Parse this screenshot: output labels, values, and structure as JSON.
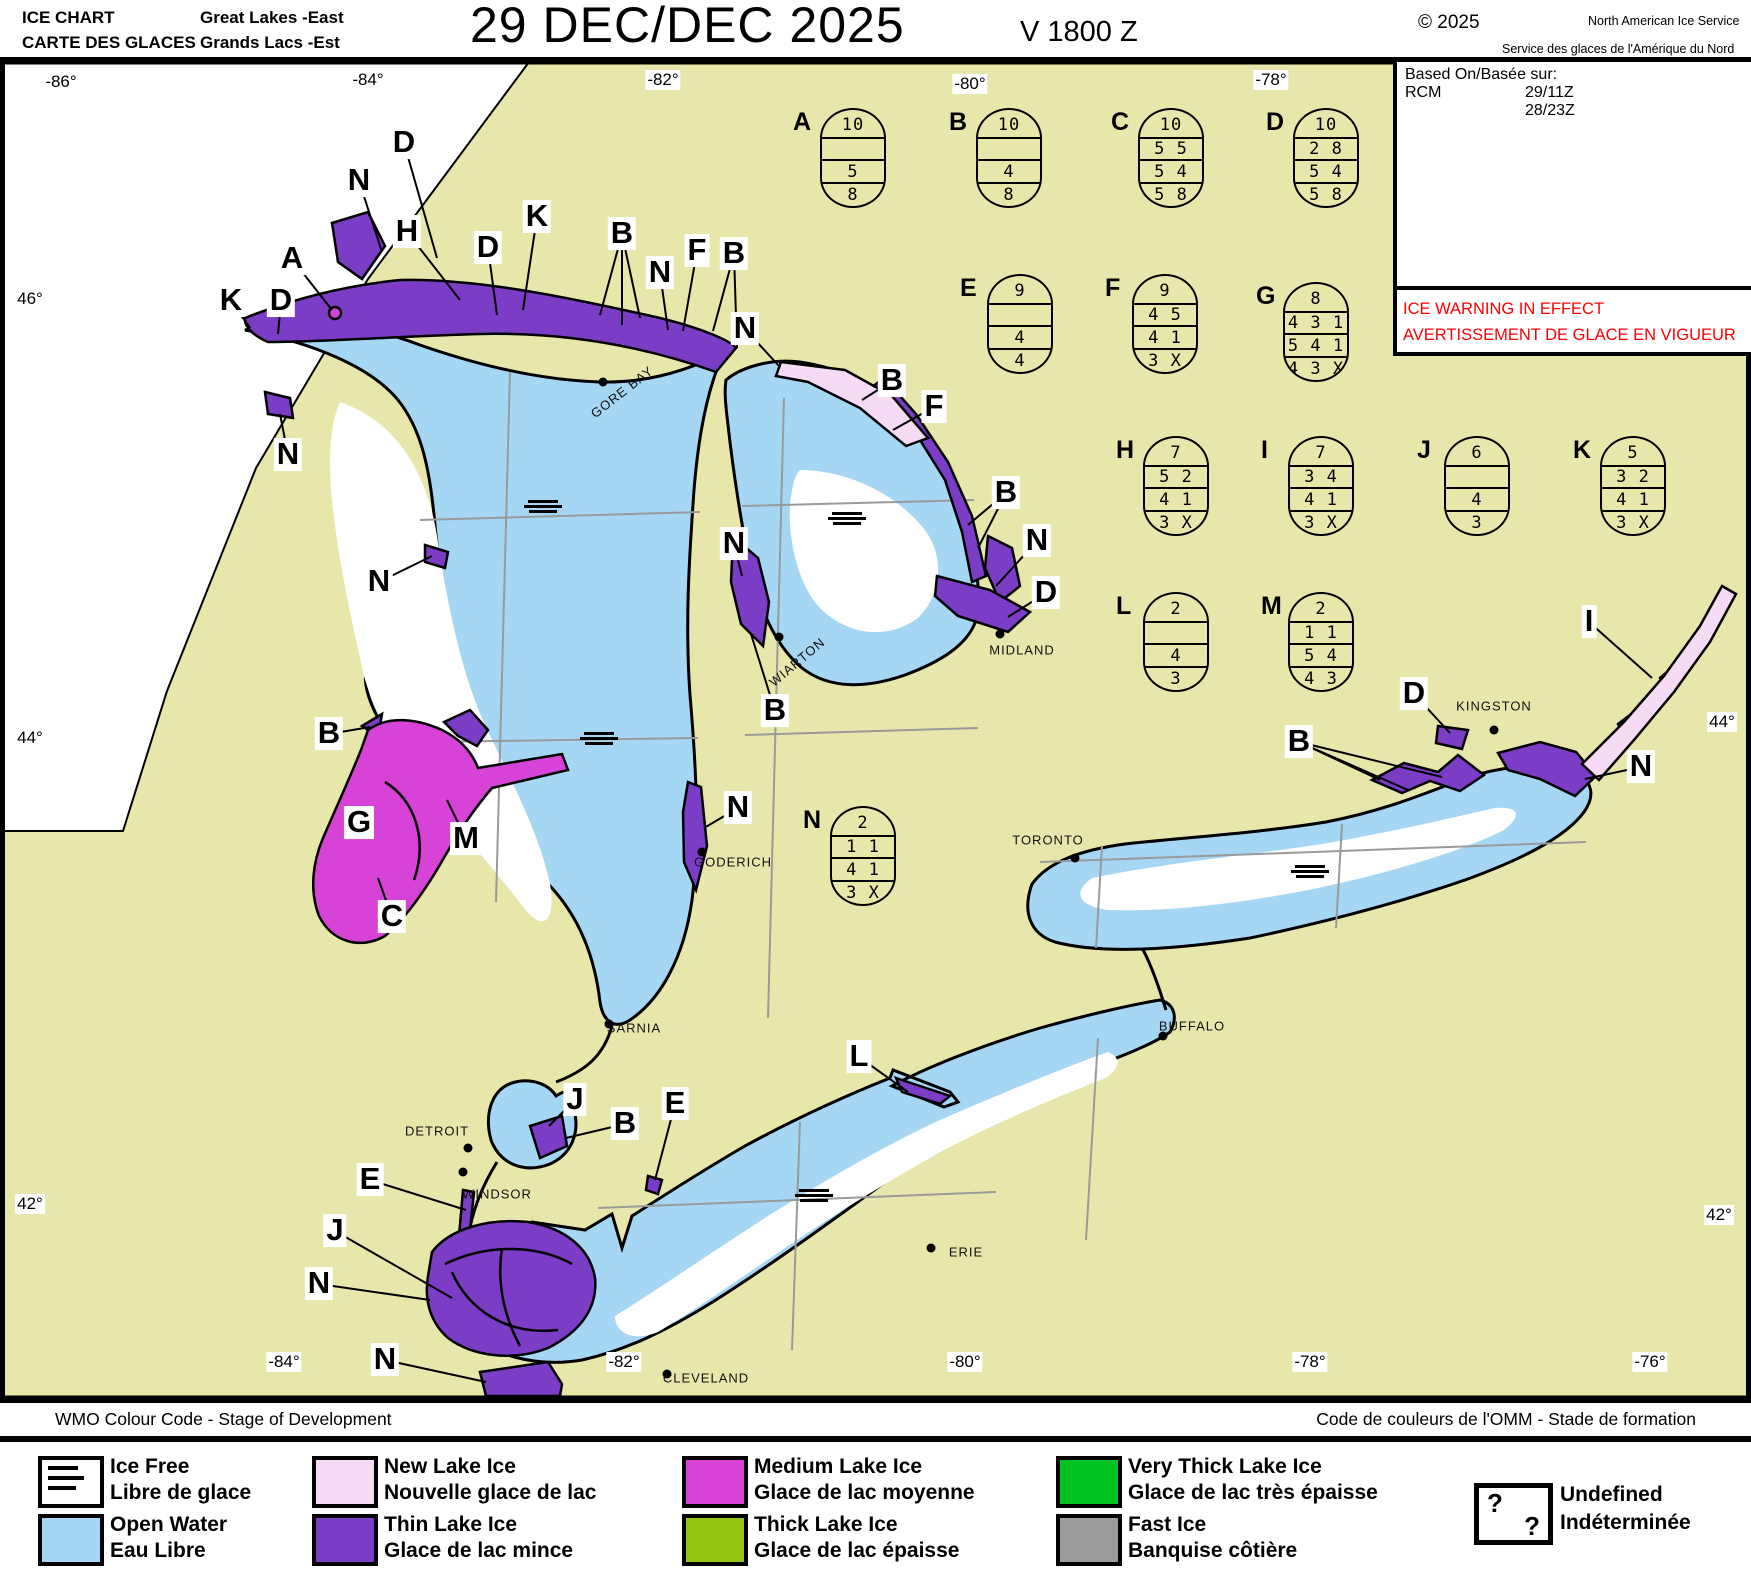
{
  "header": {
    "l1": "ICE CHART",
    "l2": "CARTE DES GLACES",
    "region_en": "Great Lakes -East",
    "region_fr": "Grands Lacs -Est",
    "title": "29 DEC/DEC 2025",
    "valid": "V 1800 Z",
    "copyright": "© 2025",
    "agency_en": "North American Ice Service",
    "agency_fr": "Service des glaces de l'Amérique du Nord"
  },
  "based_on": {
    "label": "Based On/Basée sur:",
    "source": "RCM",
    "t1": "29/11Z",
    "t2": "28/23Z"
  },
  "warning": {
    "line1": "ICE WARNING IN EFFECT",
    "line2": "AVERTISSEMENT DE GLACE EN VIGUEUR"
  },
  "colors": {
    "land": "#e8e7ab",
    "open_water": "#a5d6f4",
    "ice_free": "#ffffff",
    "new_lake_ice": "#f7dbf5",
    "thin_lake_ice": "#7b3cc6",
    "medium_lake_ice": "#d643d6",
    "thick_lake_ice": "#94c414",
    "very_thick_lake_ice": "#00c321",
    "fast_ice": "#9b9b9b",
    "warning_red": "#ff0000",
    "grid": "#9a9a9a"
  },
  "coords": {
    "top": [
      {
        "t": "-86°",
        "x": 61,
        "y": 82
      },
      {
        "t": "-84°",
        "x": 368,
        "y": 80
      },
      {
        "t": "-82°",
        "x": 663,
        "y": 80
      },
      {
        "t": "-80°",
        "x": 970,
        "y": 84
      },
      {
        "t": "-78°",
        "x": 1271,
        "y": 80
      }
    ],
    "bottom": [
      {
        "t": "-84°",
        "x": 284,
        "y": 1362
      },
      {
        "t": "-82°",
        "x": 624,
        "y": 1362
      },
      {
        "t": "-80°",
        "x": 965,
        "y": 1362
      },
      {
        "t": "-78°",
        "x": 1310,
        "y": 1362
      },
      {
        "t": "-76°",
        "x": 1650,
        "y": 1362
      }
    ],
    "left": [
      {
        "t": "46°",
        "x": 30,
        "y": 299
      },
      {
        "t": "44°",
        "x": 30,
        "y": 738
      },
      {
        "t": "42°",
        "x": 30,
        "y": 1204
      }
    ],
    "right": [
      {
        "t": "44°",
        "x": 1722,
        "y": 722
      },
      {
        "t": "42°",
        "x": 1719,
        "y": 1215
      }
    ]
  },
  "eggs": [
    {
      "id": "A",
      "x": 820,
      "y": 108,
      "rows": [
        "10",
        "",
        "5",
        "8"
      ]
    },
    {
      "id": "B",
      "x": 976,
      "y": 108,
      "rows": [
        "10",
        "",
        "4",
        "8"
      ]
    },
    {
      "id": "C",
      "x": 1138,
      "y": 108,
      "rows": [
        "10",
        "5 5",
        "5 4",
        "5 8"
      ]
    },
    {
      "id": "D",
      "x": 1293,
      "y": 108,
      "rows": [
        "10",
        "2 8",
        "5 4",
        "5 8"
      ]
    },
    {
      "id": "E",
      "x": 987,
      "y": 274,
      "rows": [
        "9",
        "",
        "4",
        "4"
      ]
    },
    {
      "id": "F",
      "x": 1132,
      "y": 274,
      "rows": [
        "9",
        "4 5",
        "4 1",
        "3 X"
      ]
    },
    {
      "id": "G",
      "x": 1283,
      "y": 282,
      "rows": [
        "8",
        "4 3 1",
        "5 4 1",
        "4 3 X"
      ]
    },
    {
      "id": "H",
      "x": 1143,
      "y": 436,
      "rows": [
        "7",
        "5 2",
        "4 1",
        "3 X"
      ]
    },
    {
      "id": "I",
      "x": 1288,
      "y": 436,
      "rows": [
        "7",
        "3 4",
        "4 1",
        "3 X"
      ]
    },
    {
      "id": "J",
      "x": 1444,
      "y": 436,
      "rows": [
        "6",
        "",
        "4",
        "3"
      ]
    },
    {
      "id": "K",
      "x": 1600,
      "y": 436,
      "rows": [
        "5",
        "3 2",
        "4 1",
        "3 X"
      ]
    },
    {
      "id": "L",
      "x": 1143,
      "y": 592,
      "rows": [
        "2",
        "",
        "4",
        "3"
      ]
    },
    {
      "id": "M",
      "x": 1288,
      "y": 592,
      "rows": [
        "2",
        "1 1",
        "5 4",
        "4 3"
      ]
    },
    {
      "id": "N",
      "x": 830,
      "y": 806,
      "rows": [
        "2",
        "1 1",
        "4 1",
        "3 X"
      ]
    }
  ],
  "letters": [
    {
      "t": "D",
      "x": 404,
      "y": 143,
      "leaders": [
        [
          437,
          258
        ]
      ]
    },
    {
      "t": "N",
      "x": 359,
      "y": 181,
      "leaders": [
        [
          382,
          252
        ]
      ]
    },
    {
      "t": "H",
      "x": 407,
      "y": 232,
      "leaders": [
        [
          460,
          300
        ]
      ]
    },
    {
      "t": "A",
      "x": 292,
      "y": 259,
      "leaders": [
        [
          332,
          310
        ]
      ]
    },
    {
      "t": "D",
      "x": 488,
      "y": 248,
      "leaders": [
        [
          497,
          315
        ]
      ]
    },
    {
      "t": "K",
      "x": 537,
      "y": 217,
      "leaders": [
        [
          523,
          310
        ]
      ]
    },
    {
      "t": "B",
      "x": 622,
      "y": 234,
      "leaders": [
        [
          600,
          315
        ],
        [
          622,
          325
        ],
        [
          640,
          318
        ]
      ]
    },
    {
      "t": "K",
      "x": 231,
      "y": 301,
      "leaders": [
        [
          250,
          328
        ]
      ]
    },
    {
      "t": "D",
      "x": 281,
      "y": 301,
      "leaders": [
        [
          278,
          334
        ]
      ]
    },
    {
      "t": "N",
      "x": 660,
      "y": 273,
      "leaders": [
        [
          668,
          330
        ]
      ]
    },
    {
      "t": "F",
      "x": 697,
      "y": 251,
      "leaders": [
        [
          683,
          331
        ]
      ]
    },
    {
      "t": "B",
      "x": 734,
      "y": 254,
      "leaders": [
        [
          713,
          331
        ],
        [
          737,
          348
        ]
      ]
    },
    {
      "t": "N",
      "x": 745,
      "y": 329,
      "leaders": [
        [
          779,
          366
        ]
      ]
    },
    {
      "t": "B",
      "x": 892,
      "y": 381,
      "leaders": [
        [
          862,
          400
        ]
      ]
    },
    {
      "t": "F",
      "x": 934,
      "y": 407,
      "leaders": [
        [
          893,
          430
        ]
      ]
    },
    {
      "t": "N",
      "x": 288,
      "y": 455,
      "leaders": [
        [
          280,
          414
        ]
      ]
    },
    {
      "t": "N",
      "x": 379,
      "y": 582,
      "leaders": [
        [
          432,
          556
        ]
      ]
    },
    {
      "t": "B",
      "x": 1006,
      "y": 493,
      "leaders": [
        [
          968,
          525
        ],
        [
          978,
          548
        ]
      ]
    },
    {
      "t": "N",
      "x": 1037,
      "y": 541,
      "leaders": [
        [
          996,
          586
        ]
      ]
    },
    {
      "t": "D",
      "x": 1046,
      "y": 593,
      "leaders": [
        [
          1008,
          617
        ]
      ]
    },
    {
      "t": "N",
      "x": 734,
      "y": 544,
      "leaders": [
        [
          742,
          576
        ]
      ]
    },
    {
      "t": "B",
      "x": 775,
      "y": 711,
      "leaders": [
        [
          751,
          634
        ]
      ]
    },
    {
      "t": "B",
      "x": 329,
      "y": 734,
      "leaders": [
        [
          370,
          727
        ]
      ]
    },
    {
      "t": "G",
      "x": 359,
      "y": 823,
      "leaders": []
    },
    {
      "t": "M",
      "x": 466,
      "y": 839,
      "leaders": [
        [
          447,
          800
        ]
      ]
    },
    {
      "t": "C",
      "x": 392,
      "y": 917,
      "leaders": [
        [
          378,
          878
        ]
      ]
    },
    {
      "t": "N",
      "x": 738,
      "y": 808,
      "leaders": [
        [
          704,
          828
        ]
      ]
    },
    {
      "t": "B",
      "x": 1299,
      "y": 742,
      "leaders": [
        [
          1380,
          780
        ],
        [
          1408,
          790
        ],
        [
          1442,
          777
        ]
      ]
    },
    {
      "t": "D",
      "x": 1414,
      "y": 694,
      "leaders": [
        [
          1450,
          733
        ]
      ]
    },
    {
      "t": "I",
      "x": 1589,
      "y": 622,
      "leaders": [
        [
          1652,
          678
        ]
      ]
    },
    {
      "t": "N",
      "x": 1641,
      "y": 767,
      "leaders": [
        [
          1585,
          779
        ]
      ]
    },
    {
      "t": "L",
      "x": 859,
      "y": 1057,
      "leaders": [
        [
          908,
          1092
        ]
      ]
    },
    {
      "t": "J",
      "x": 575,
      "y": 1100,
      "leaders": [
        [
          549,
          1126
        ]
      ]
    },
    {
      "t": "B",
      "x": 625,
      "y": 1124,
      "leaders": [
        [
          566,
          1138
        ]
      ]
    },
    {
      "t": "E",
      "x": 675,
      "y": 1104,
      "leaders": [
        [
          655,
          1180
        ]
      ]
    },
    {
      "t": "E",
      "x": 370,
      "y": 1180,
      "leaders": [
        [
          466,
          1210
        ]
      ]
    },
    {
      "t": "J",
      "x": 335,
      "y": 1231,
      "leaders": [
        [
          452,
          1298
        ]
      ]
    },
    {
      "t": "N",
      "x": 319,
      "y": 1284,
      "leaders": [
        [
          430,
          1300
        ]
      ]
    },
    {
      "t": "N",
      "x": 385,
      "y": 1360,
      "leaders": [
        [
          486,
          1382
        ]
      ]
    }
  ],
  "cities": [
    {
      "name": "GORE BAY",
      "x": 622,
      "y": 392,
      "rot": -38,
      "dot": [
        603,
        382
      ]
    },
    {
      "name": "WIARTON",
      "x": 797,
      "y": 662,
      "rot": -40,
      "dot": [
        779,
        637
      ]
    },
    {
      "name": "MIDLAND",
      "x": 1022,
      "y": 650,
      "rot": 0,
      "dot": [
        1000,
        634
      ]
    },
    {
      "name": "GODERICH",
      "x": 733,
      "y": 862,
      "rot": 0,
      "dot": [
        702,
        852
      ]
    },
    {
      "name": "TORONTO",
      "x": 1048,
      "y": 840,
      "rot": 0,
      "dot": [
        1075,
        858
      ]
    },
    {
      "name": "KINGSTON",
      "x": 1494,
      "y": 706,
      "rot": 0,
      "dot": [
        1494,
        730
      ]
    },
    {
      "name": "BUFFALO",
      "x": 1192,
      "y": 1026,
      "rot": 0,
      "dot": [
        1163,
        1036
      ]
    },
    {
      "name": "SARNIA",
      "x": 634,
      "y": 1028,
      "rot": 0,
      "dot": [
        609,
        1024
      ]
    },
    {
      "name": "DETROIT",
      "x": 437,
      "y": 1131,
      "rot": 0,
      "dot": [
        468,
        1148
      ]
    },
    {
      "name": "WINDSOR",
      "x": 497,
      "y": 1194,
      "rot": 0,
      "dot": [
        463,
        1172
      ]
    },
    {
      "name": "ERIE",
      "x": 966,
      "y": 1252,
      "rot": 0,
      "dot": [
        931,
        1248
      ]
    },
    {
      "name": "CLEVELAND",
      "x": 706,
      "y": 1378,
      "rot": 0,
      "dot": [
        667,
        1374
      ]
    }
  ],
  "ice_free_symbols": [
    [
      543,
      507
    ],
    [
      599,
      739
    ],
    [
      847,
      519
    ],
    [
      1310,
      872
    ],
    [
      814,
      1196
    ]
  ],
  "legend": {
    "title_en": "WMO Colour Code - Stage of Development",
    "title_fr": "Code de couleurs de l'OMM - Stade de formation",
    "items": [
      {
        "key": "ice-free",
        "symbol": "lines",
        "color": "#ffffff",
        "en": "Ice Free",
        "fr": "Libre de glace",
        "x": 38,
        "row": 0
      },
      {
        "key": "open-water",
        "color": "#a5d6f4",
        "en": "Open Water",
        "fr": "Eau Libre",
        "x": 38,
        "row": 1
      },
      {
        "key": "new-lake-ice",
        "color": "#f7dbf5",
        "en": "New Lake Ice",
        "fr": "Nouvelle glace de lac",
        "x": 312,
        "row": 0
      },
      {
        "key": "thin-lake-ice",
        "color": "#7b3cc6",
        "en": "Thin Lake Ice",
        "fr": "Glace de lac mince",
        "x": 312,
        "row": 1
      },
      {
        "key": "medium-lake-ice",
        "color": "#d643d6",
        "en": "Medium Lake Ice",
        "fr": "Glace de lac moyenne",
        "x": 682,
        "row": 0
      },
      {
        "key": "thick-lake-ice",
        "color": "#94c414",
        "en": "Thick Lake Ice",
        "fr": "Glace de lac épaisse",
        "x": 682,
        "row": 1
      },
      {
        "key": "very-thick-lake-ice",
        "color": "#00c321",
        "en": "Very Thick Lake Ice",
        "fr": "Glace de lac très épaisse",
        "x": 1056,
        "row": 0
      },
      {
        "key": "fast-ice",
        "color": "#9b9b9b",
        "en": "Fast Ice",
        "fr": "Banquise côtière",
        "x": 1056,
        "row": 1
      }
    ],
    "undefined": {
      "q": "?",
      "en": "Undefined",
      "fr": "Indéterminée"
    }
  }
}
